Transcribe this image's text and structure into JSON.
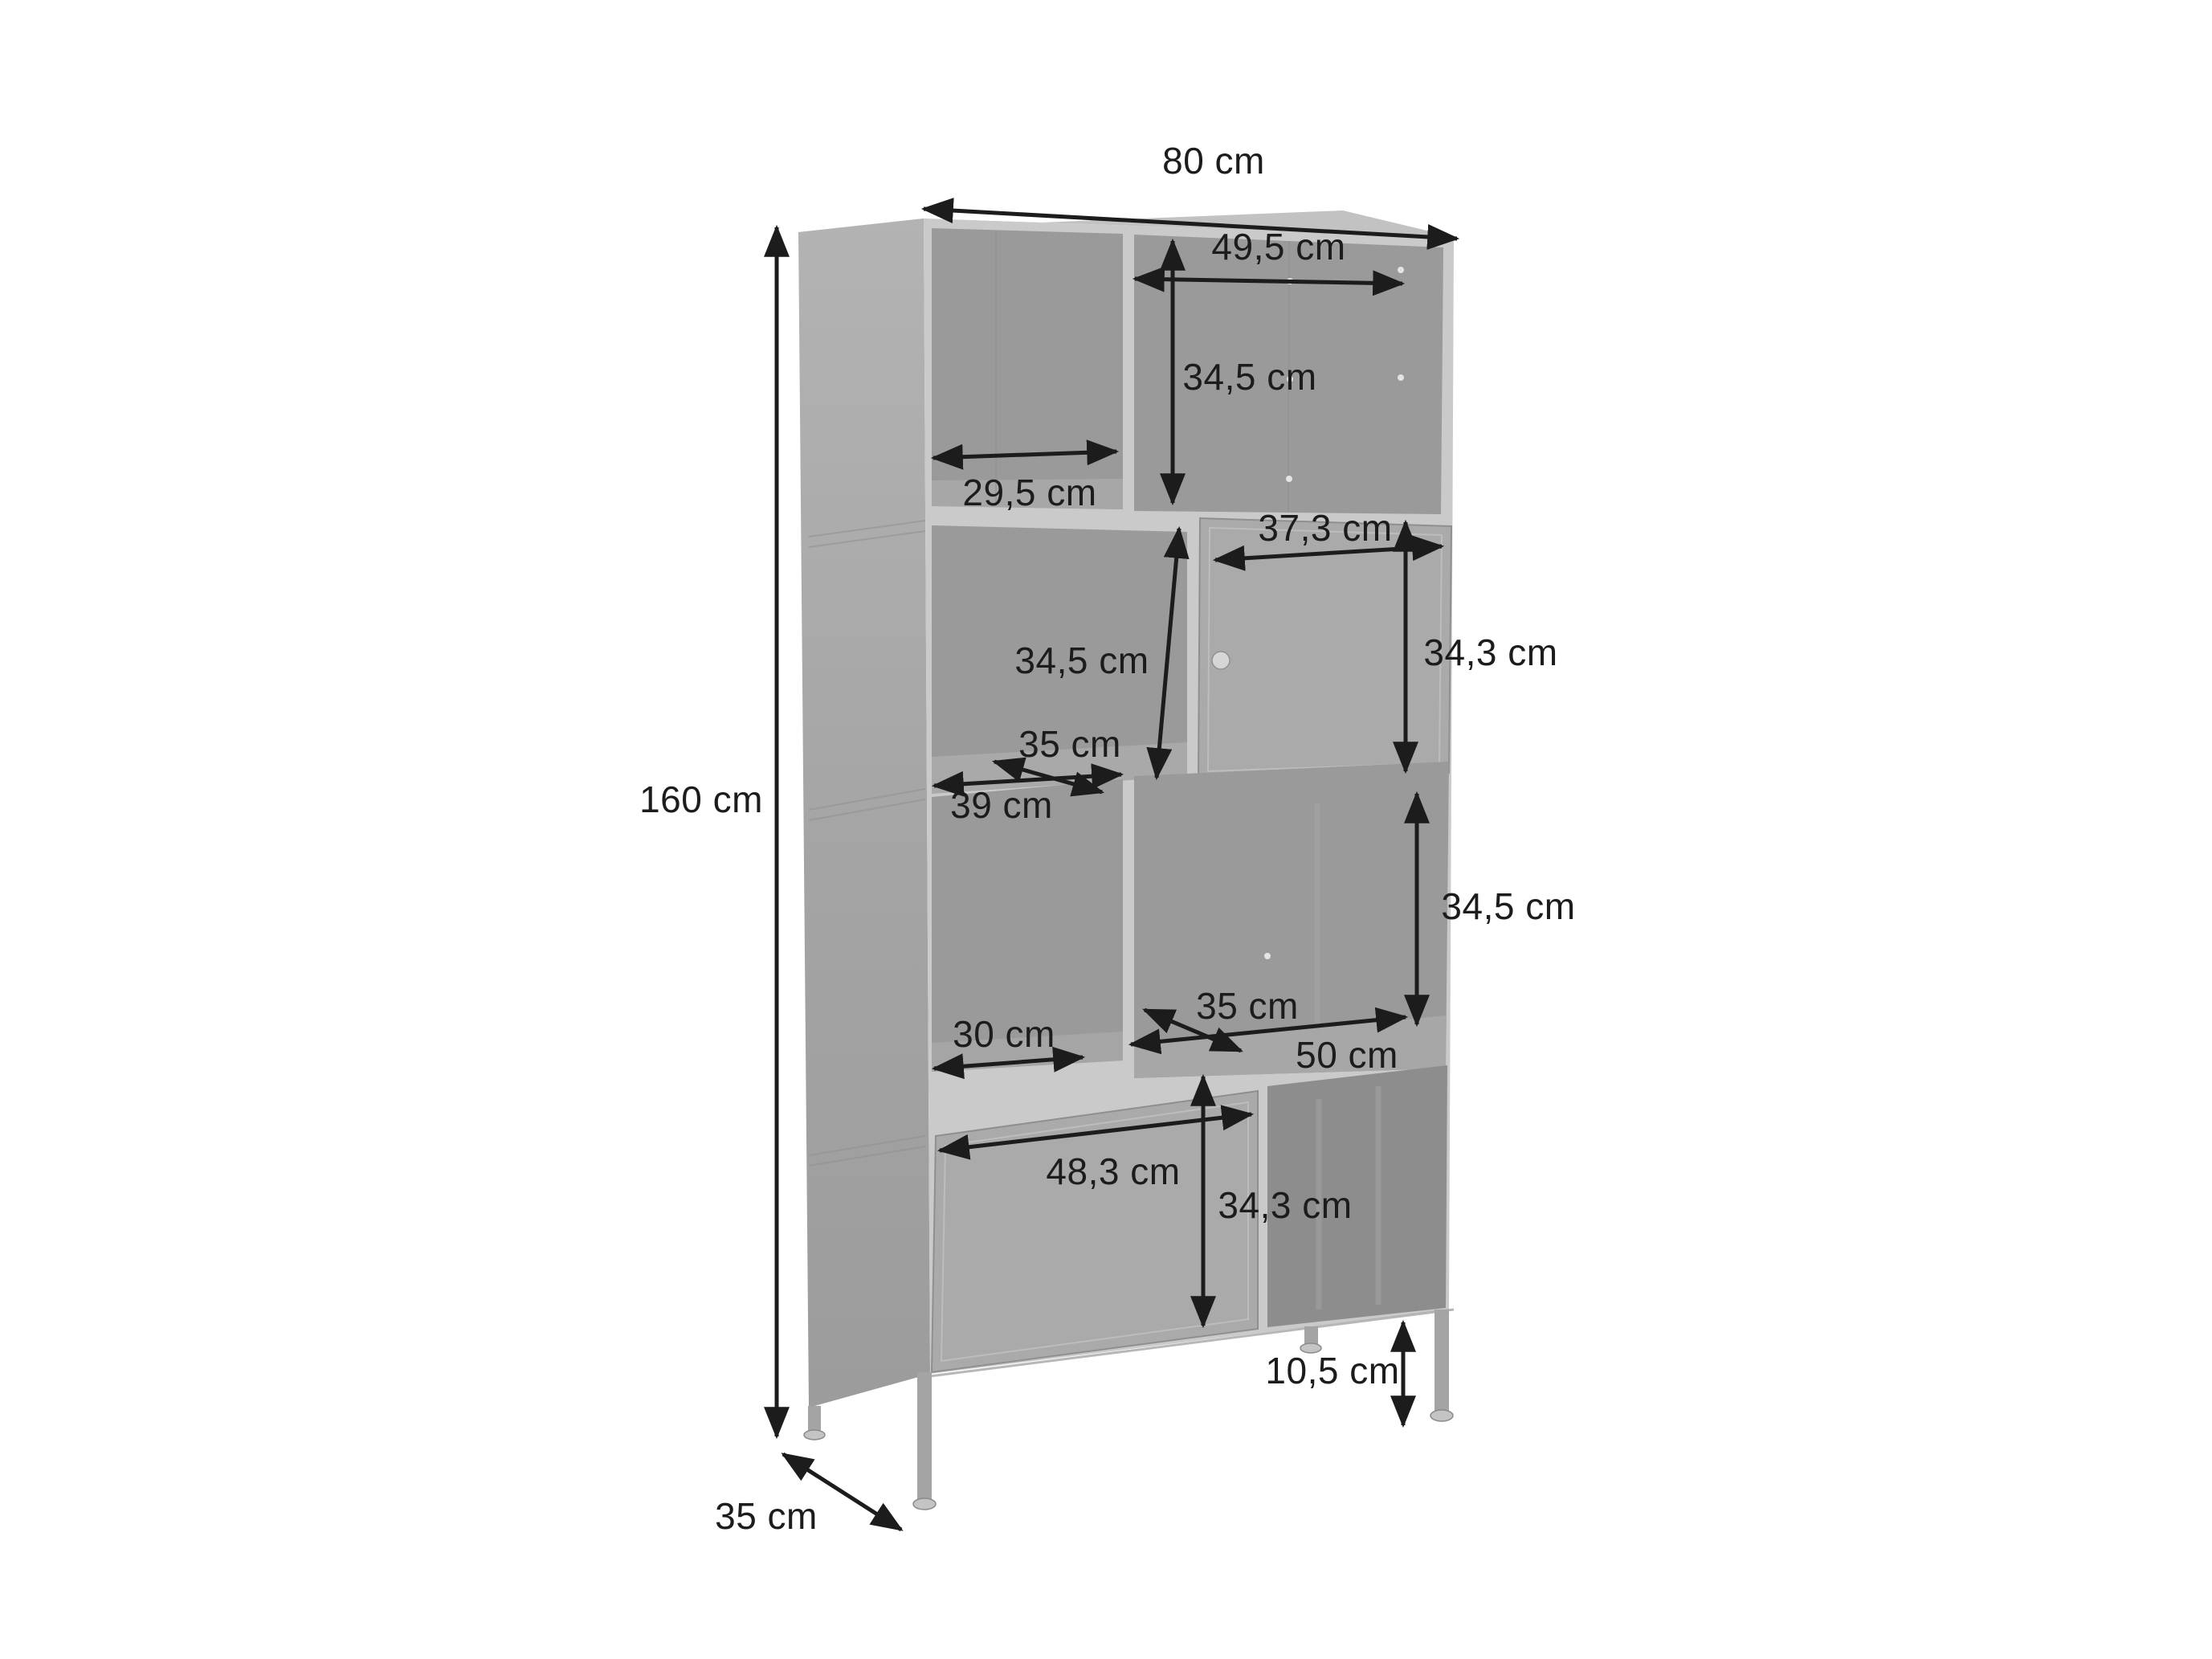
{
  "diagram": {
    "description": "dimension line drawing of a tall grey metal cabinet with eight compartments, two doors and four legs",
    "unit": "cm"
  },
  "dims": {
    "overall_width": {
      "label": "80 cm",
      "value": 80
    },
    "overall_height": {
      "label": "160 cm",
      "value": 160
    },
    "overall_depth": {
      "label": "35 cm",
      "value": 35
    },
    "row1_right_width": {
      "label": "49,5 cm",
      "value": 49.5
    },
    "row1_right_height": {
      "label": "34,5 cm",
      "value": 34.5
    },
    "row1_left_width": {
      "label": "29,5 cm",
      "value": 29.5
    },
    "row2_door_width": {
      "label": "37,3 cm",
      "value": 37.3
    },
    "row2_door_height": {
      "label": "34,3 cm",
      "value": 34.3
    },
    "row2_left_height": {
      "label": "34,5 cm",
      "value": 34.5
    },
    "row2_left_depth": {
      "label": "35 cm",
      "value": 35
    },
    "row2_left_width": {
      "label": "39 cm",
      "value": 39
    },
    "row3_right_height": {
      "label": "34,5 cm",
      "value": 34.5
    },
    "row3_right_depth": {
      "label": "35 cm",
      "value": 35
    },
    "row3_right_width": {
      "label": "50 cm",
      "value": 50
    },
    "row3_left_width": {
      "label": "30 cm",
      "value": 30
    },
    "row4_door_width": {
      "label": "48,3 cm",
      "value": 48.3
    },
    "row4_door_height": {
      "label": "34,3 cm",
      "value": 34.3
    },
    "leg_height": {
      "label": "10,5 cm",
      "value": 10.5
    }
  },
  "colors": {
    "dimension_ink": "#1c1c1c",
    "frame": "#cacaca",
    "side_panel": "#a6a6a6",
    "interior": "#9a9a9a",
    "interior_dark": "#8d8d8d",
    "door": "#aaaaaa",
    "background": "#ffffff"
  }
}
